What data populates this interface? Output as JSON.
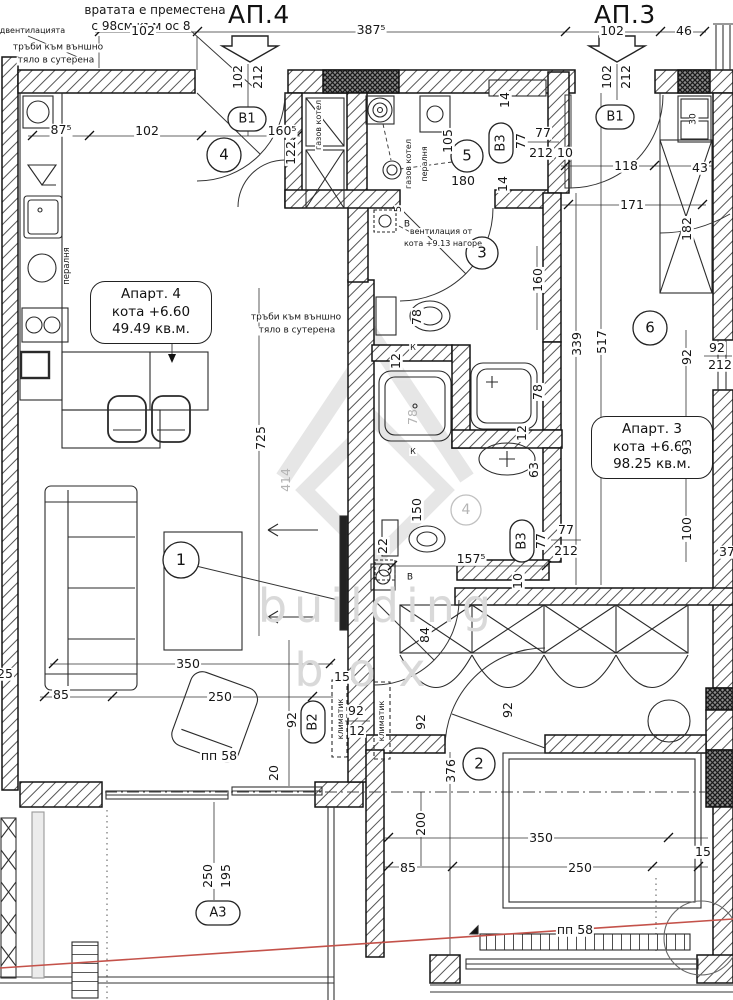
{
  "drawing": {
    "apartment_left": {
      "title": "АП.4",
      "name": "Апарт. 4",
      "level": "кота +6.60",
      "area": "49.49 кв.м."
    },
    "apartment_right": {
      "title": "АП.3",
      "name": "Апарт. 3",
      "level": "кота +6.60",
      "area": "98.25 кв.м."
    },
    "watermark": {
      "line1": "building",
      "line2": "box"
    },
    "colors": {
      "red_marker_line": "#c4524a",
      "watermark_gray": "#d9d9d9"
    },
    "labels": [
      {
        "t": "вратата е преместена",
        "x": 155,
        "y": 10,
        "s": 12
      },
      {
        "t": "с 98см към ос 8",
        "x": 141,
        "y": 26,
        "s": 12
      },
      {
        "t": "одвентилацията",
        "x": 30,
        "y": 31,
        "s": 8
      },
      {
        "t": "тръби към външно",
        "x": 58,
        "y": 48,
        "s": 9
      },
      {
        "t": "тяло в сутерена",
        "x": 56,
        "y": 61,
        "s": 9
      },
      {
        "t": "102",
        "x": 143,
        "y": 31
      },
      {
        "t": "387⁵",
        "x": 371,
        "y": 30
      },
      {
        "t": "102",
        "x": 612,
        "y": 31
      },
      {
        "t": "46",
        "x": 684,
        "y": 31
      },
      {
        "t": "87⁵",
        "x": 61,
        "y": 130
      },
      {
        "t": "102",
        "x": 147,
        "y": 131
      },
      {
        "t": "160⁵",
        "x": 282,
        "y": 131
      },
      {
        "t": "102",
        "x": 238,
        "y": 77,
        "r": -90
      },
      {
        "t": "212",
        "x": 258,
        "y": 77,
        "r": -90
      },
      {
        "t": "122",
        "x": 291,
        "y": 153,
        "r": -90
      },
      {
        "t": "В1",
        "x": 247,
        "y": 119,
        "s": 13,
        "n": "door-tag-b1-left"
      },
      {
        "t": "пералня",
        "x": 67,
        "y": 266,
        "r": -90,
        "s": 8.5
      },
      {
        "t": "газов котел",
        "x": 319,
        "y": 125,
        "r": -90,
        "s": 8
      },
      {
        "t": "газов котел",
        "x": 409,
        "y": 164,
        "r": -90,
        "s": 8
      },
      {
        "t": "пералня",
        "x": 425,
        "y": 164,
        "r": -90,
        "s": 8
      },
      {
        "t": "105",
        "x": 448,
        "y": 141,
        "r": -90
      },
      {
        "t": "180",
        "x": 463,
        "y": 181
      },
      {
        "t": "14",
        "x": 505,
        "y": 100,
        "r": -90
      },
      {
        "t": "14",
        "x": 503,
        "y": 184,
        "r": -90
      },
      {
        "t": "В3",
        "x": 501,
        "y": 143,
        "r": -90,
        "s": 13,
        "n": "door-tag-b3-top"
      },
      {
        "t": "77",
        "x": 521,
        "y": 141,
        "r": -90
      },
      {
        "t": "77",
        "x": 543,
        "y": 133
      },
      {
        "t": "212",
        "x": 541,
        "y": 153
      },
      {
        "t": "10",
        "x": 565,
        "y": 153
      },
      {
        "t": "5",
        "x": 399,
        "y": 209,
        "r": -90,
        "s": 10
      },
      {
        "t": "В",
        "x": 407,
        "y": 225,
        "s": 9
      },
      {
        "t": "вентилация от",
        "x": 441,
        "y": 232,
        "s": 8
      },
      {
        "t": "кота +9.13 нагоре",
        "x": 443,
        "y": 244,
        "s": 8
      },
      {
        "t": "78",
        "x": 417,
        "y": 317,
        "r": -90
      },
      {
        "t": "160",
        "x": 538,
        "y": 280,
        "r": -90
      },
      {
        "t": "К",
        "x": 413,
        "y": 348,
        "s": 8
      },
      {
        "t": "12",
        "x": 396,
        "y": 361,
        "r": -90
      },
      {
        "t": "78",
        "x": 413,
        "y": 417,
        "r": -90,
        "cls": "gray"
      },
      {
        "t": "78",
        "x": 538,
        "y": 392,
        "r": -90
      },
      {
        "t": "12",
        "x": 522,
        "y": 433,
        "r": -90
      },
      {
        "t": "63",
        "x": 534,
        "y": 470,
        "r": -90
      },
      {
        "t": "К",
        "x": 413,
        "y": 452,
        "s": 8
      },
      {
        "t": "150",
        "x": 417,
        "y": 510,
        "r": -90
      },
      {
        "t": "22",
        "x": 383,
        "y": 546,
        "r": -90
      },
      {
        "t": "В",
        "x": 410,
        "y": 578,
        "s": 9
      },
      {
        "t": "157⁵",
        "x": 471,
        "y": 559
      },
      {
        "t": "10",
        "x": 518,
        "y": 581,
        "r": -90
      },
      {
        "t": "В3",
        "x": 522,
        "y": 541,
        "r": -90,
        "s": 13,
        "n": "door-tag-b3-bottom"
      },
      {
        "t": "77",
        "x": 541,
        "y": 541,
        "r": -90
      },
      {
        "t": "77",
        "x": 566,
        "y": 530
      },
      {
        "t": "212",
        "x": 566,
        "y": 551
      },
      {
        "t": "339",
        "x": 577,
        "y": 344,
        "r": -90
      },
      {
        "t": "517",
        "x": 602,
        "y": 342,
        "r": -90
      },
      {
        "t": "102",
        "x": 607,
        "y": 77,
        "r": -90
      },
      {
        "t": "212",
        "x": 626,
        "y": 77,
        "r": -90
      },
      {
        "t": "В1",
        "x": 615,
        "y": 117,
        "s": 13,
        "n": "door-tag-b1-right"
      },
      {
        "t": "30",
        "x": 694,
        "y": 119,
        "r": -90,
        "s": 9
      },
      {
        "t": "118",
        "x": 626,
        "y": 166
      },
      {
        "t": "43",
        "x": 700,
        "y": 168
      },
      {
        "t": "171",
        "x": 632,
        "y": 205
      },
      {
        "t": "182",
        "x": 687,
        "y": 229,
        "r": -90
      },
      {
        "t": "92",
        "x": 687,
        "y": 357,
        "r": -90
      },
      {
        "t": "92",
        "x": 717,
        "y": 348
      },
      {
        "t": "212",
        "x": 720,
        "y": 365
      },
      {
        "t": "93",
        "x": 687,
        "y": 447,
        "r": -90
      },
      {
        "t": "100",
        "x": 687,
        "y": 529,
        "r": -90
      },
      {
        "t": "37",
        "x": 727,
        "y": 552
      },
      {
        "t": "84",
        "x": 425,
        "y": 635,
        "r": -90
      },
      {
        "t": "тръби към външно",
        "x": 296,
        "y": 318,
        "s": 9
      },
      {
        "t": "тяло в сутерена",
        "x": 297,
        "y": 331,
        "s": 9
      },
      {
        "t": "725",
        "x": 261,
        "y": 438,
        "r": -90
      },
      {
        "t": "414",
        "x": 286,
        "y": 480,
        "r": -90,
        "cls": "gray"
      },
      {
        "t": "350",
        "x": 188,
        "y": 664
      },
      {
        "t": "85",
        "x": 61,
        "y": 695
      },
      {
        "t": "250",
        "x": 220,
        "y": 697
      },
      {
        "t": "25",
        "x": 5,
        "y": 674
      },
      {
        "t": "92",
        "x": 292,
        "y": 720,
        "r": -90
      },
      {
        "t": "15",
        "x": 342,
        "y": 677
      },
      {
        "t": "климатик",
        "x": 341,
        "y": 719,
        "r": -90,
        "s": 8
      },
      {
        "t": "климатик",
        "x": 382,
        "y": 721,
        "r": -90,
        "s": 8
      },
      {
        "t": "92",
        "x": 356,
        "y": 711
      },
      {
        "t": "12",
        "x": 357,
        "y": 731
      },
      {
        "t": "В2",
        "x": 313,
        "y": 722,
        "r": -90,
        "s": 13,
        "n": "door-tag-b2"
      },
      {
        "t": "92",
        "x": 421,
        "y": 722,
        "r": -90
      },
      {
        "t": "92",
        "x": 508,
        "y": 710,
        "r": -90
      },
      {
        "t": "20",
        "x": 274,
        "y": 773,
        "r": -90
      },
      {
        "t": "пп 58",
        "x": 219,
        "y": 756
      },
      {
        "t": "250",
        "x": 208,
        "y": 876,
        "r": -90
      },
      {
        "t": "195",
        "x": 226,
        "y": 876,
        "r": -90
      },
      {
        "t": "А3",
        "x": 218,
        "y": 913,
        "s": 13,
        "n": "door-tag-a3"
      },
      {
        "t": "376",
        "x": 451,
        "y": 771,
        "r": -90
      },
      {
        "t": "200",
        "x": 421,
        "y": 824,
        "r": -90
      },
      {
        "t": "85",
        "x": 408,
        "y": 868
      },
      {
        "t": "350",
        "x": 541,
        "y": 838
      },
      {
        "t": "250",
        "x": 580,
        "y": 868
      },
      {
        "t": "15",
        "x": 703,
        "y": 852
      },
      {
        "t": "пп 58",
        "x": 575,
        "y": 930
      },
      {
        "t": "4",
        "x": 224,
        "y": 155,
        "s": 15,
        "n": "room-number-4"
      },
      {
        "t": "5",
        "x": 467,
        "y": 156,
        "s": 15,
        "n": "room-number-5"
      },
      {
        "t": "3",
        "x": 482,
        "y": 253,
        "s": 15,
        "n": "room-number-3"
      },
      {
        "t": "6",
        "x": 650,
        "y": 328,
        "s": 15,
        "n": "room-number-6"
      },
      {
        "t": "1",
        "x": 181,
        "y": 560,
        "s": 16,
        "n": "room-number-1"
      },
      {
        "t": "2",
        "x": 479,
        "y": 764,
        "s": 15,
        "n": "room-number-2"
      },
      {
        "t": "4",
        "x": 466,
        "y": 510,
        "s": 14,
        "cls": "gray",
        "n": "room-number-4b"
      }
    ]
  }
}
